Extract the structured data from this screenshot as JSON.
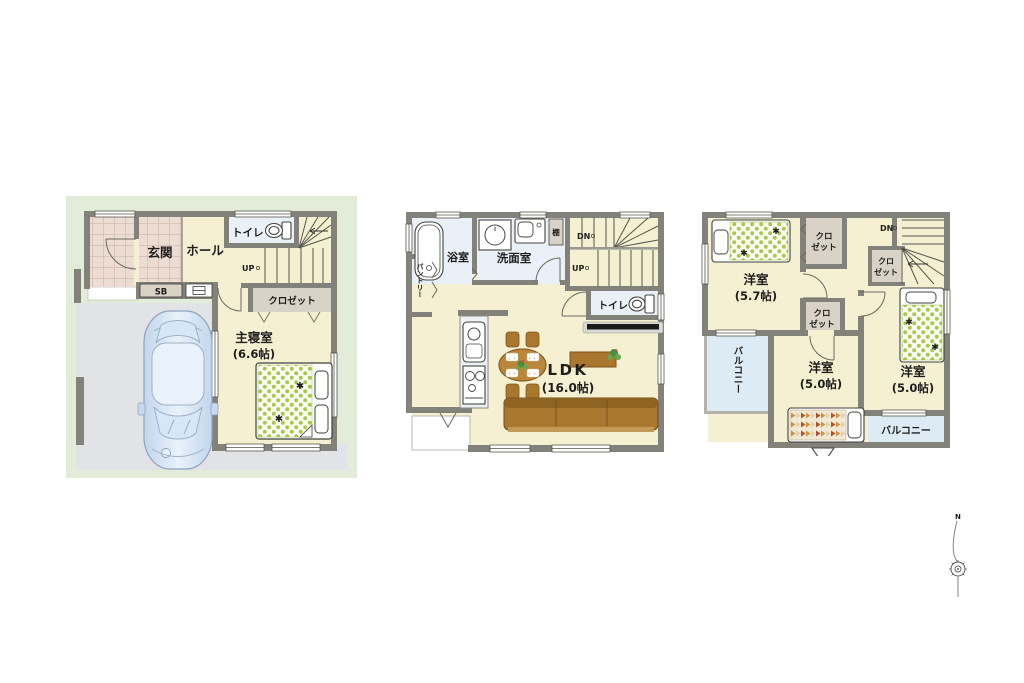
{
  "colors": {
    "wall": "#82817a",
    "floor_cream": "#f6f0d2",
    "tile_pink": "#ecdcd2",
    "water_blue": "#eaf0f7",
    "closet_gray": "#d9d2c7",
    "yard_green": "#e2ecd8",
    "pavement_gray": "#e2e3e7",
    "balcony_blue": "#ddecf4",
    "wood_brown": "#a9772e",
    "polka_dot_green": "#a8c94b",
    "accent_purple": "#9a6cc8",
    "accent_cyan": "#5bc8ee",
    "accent_pink": "#e35fa8",
    "car_blue": "#c2d6ec"
  },
  "floor1": {
    "labels": {
      "genkan": "玄関",
      "hall": "ホール",
      "toilet": "トイレ",
      "shoebox": "SB",
      "closet": "クロゼット",
      "master_bedroom": "主寝室",
      "master_bedroom_size": "(6.6帖)",
      "stairs_up": "UP"
    }
  },
  "floor2": {
    "labels": {
      "bathroom": "浴室",
      "washroom": "洗面室",
      "shelf": "棚",
      "toilet": "トイレ",
      "pantry": "パントリー",
      "ldk": "LDK",
      "ldk_size": "(16.0帖)",
      "stairs_down": "DN",
      "stairs_up": "UP"
    }
  },
  "floor3": {
    "labels": {
      "room_a": "洋室",
      "room_a_size": "(5.7帖)",
      "room_b": "洋室",
      "room_b_size": "(5.0帖)",
      "room_c": "洋室",
      "room_c_size": "(5.0帖)",
      "closet_top_line1": "クロ",
      "closet_top_line2": "ゼット",
      "closet_mid_line1": "クロ",
      "closet_mid_line2": "ゼット",
      "closet_stair_line1": "クロ",
      "closet_stair_line2": "ゼット",
      "balcony_left": "バルコニー",
      "balcony_bottom": "バルコニー",
      "stairs_down": "DN"
    }
  },
  "compass": {
    "north_label": "N"
  }
}
